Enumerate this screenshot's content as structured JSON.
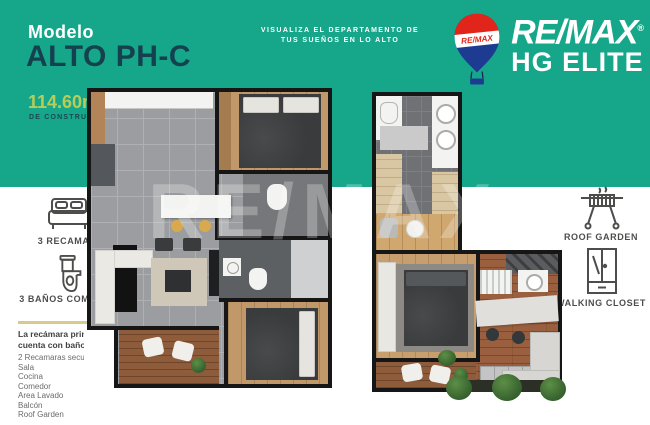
{
  "canvas": {
    "width": 650,
    "height": 425
  },
  "colors": {
    "teal_background": "#16a78b",
    "title_navy": "#15414f",
    "area_green": "#b6cd5a",
    "divider_gold": "#d9ca8c",
    "remax_red": "#e1251b",
    "remax_blue": "#1d3c91",
    "label_gray": "#4d4e4c",
    "list_gray": "#6a6b6d"
  },
  "header": {
    "model_label": "Modelo",
    "model_name": "ALTO PH-C",
    "area": "114.60m²",
    "area_caption": "DE CONSTRUCCION",
    "tagline_line1": "VISUALIZA EL DEPARTAMENTO DE",
    "tagline_line2": "TUS SUEÑOS EN LO ALTO"
  },
  "brand": {
    "balloon_label": "RE/MAX",
    "wordmark": "RE/MAX",
    "trademark": "®",
    "office": "HG ELITE"
  },
  "left_panel": {
    "bedrooms_label": "3 RECAMARAS",
    "bathrooms_label": "3 BAÑOS COMPLETOS",
    "highlight_line1": "La recámara principal",
    "highlight_line2": "cuenta con baño vestidor",
    "amenities": [
      "2 Recamaras secundarias",
      "Sala",
      "Cocina",
      "Comedor",
      "Area Lavado",
      "Balcón",
      "Roof Garden"
    ]
  },
  "right_panel": {
    "roof_garden_label": "ROOF GARDEN",
    "walking_closet_label": "WALKING CLOSET"
  },
  "watermark": {
    "text": "RE/MAX"
  }
}
